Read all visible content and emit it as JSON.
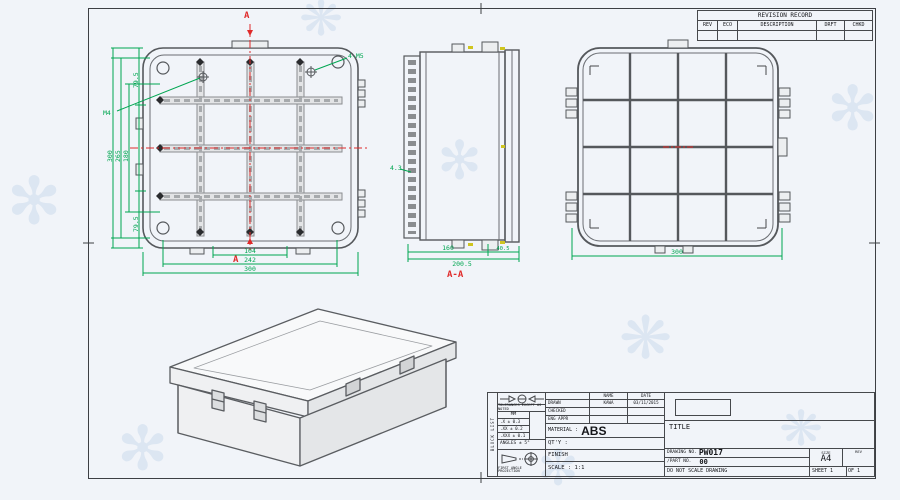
{
  "revision_table": {
    "title": "REVISION RECORD",
    "columns": [
      "REV",
      "ECO",
      "DESCRIPTION",
      "DRFT",
      "CHKD"
    ]
  },
  "front_view": {
    "section_label_top": "A",
    "section_label_bottom": "A",
    "callout_m4": "M4",
    "callout_corner": "4-M5",
    "dim_left_outer": "300",
    "dim_left_mid": "265",
    "dim_left_inner": "180",
    "dim_left_top_seg": "79.5",
    "dim_left_bottom_seg": "79.5",
    "dim_bottom_inner": "104",
    "dim_bottom_mid": "242",
    "dim_bottom_outer": "300"
  },
  "section_view": {
    "label": "A-A",
    "dim_body": "160",
    "dim_lid": "40.5",
    "dim_total": "200.5",
    "callout_hole": "4.3"
  },
  "rear_view": {
    "dim_width": "300"
  },
  "title_block": {
    "side_label": "BLOCK LIST",
    "tolerances": {
      "header": "TOLERANCES EXCEPT AS NOTED",
      "unit": "MM",
      "rows": [
        ".X ± 0.3",
        ".XX ± 0.2",
        ".XXX ± 0.1"
      ],
      "angles": "ANGLES ± 5°",
      "projection_label": "FIRST ANGLE PROJECTION"
    },
    "approvals": {
      "name_header": "NAME",
      "date_header": "DATE",
      "drawn_label": "DRAWN",
      "drawn_name": "KAWA",
      "drawn_date": "03/11/2015",
      "checked_label": "CHECKED",
      "eng_appr_label": "ENG APPR"
    },
    "material_label": "MATERIAL :",
    "material_value": "ABS",
    "qty_label": "QT'Y :",
    "finish_label": "FINISH",
    "scale_label": "SCALE : 1:1",
    "title_label": "TITLE",
    "drawing_no_label": "DRAWING NO.",
    "drawing_no_value": "PW017",
    "part_no_label": "/PART  NO.",
    "part_no_value": "00",
    "size_label": "SIZE",
    "size_value": "A4",
    "rev_label": "REV",
    "do_not_scale": "DO NOT SCALE DRAWING",
    "sheet_label": "SHEET 1",
    "of_label": "OF 1"
  }
}
